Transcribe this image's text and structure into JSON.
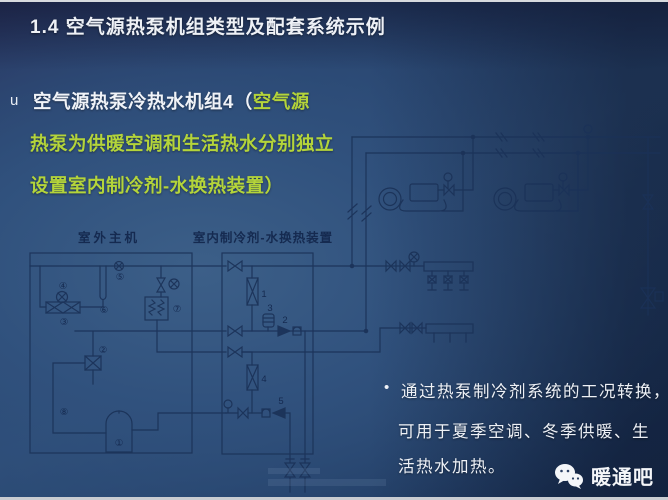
{
  "slide": {
    "title": "1.4 空气源热泵机组类型及配套系统示例",
    "bullet": {
      "marker": "u",
      "white_text": "空气源热泵冷热水机组4（",
      "green_inline": "空气源",
      "green_line2": "热泵为供暖空调和生活热水分别独立",
      "green_line3": "设置室内制冷剂-水换热装置）"
    },
    "note": {
      "marker": "•",
      "line1": "通过热泵制冷剂系统的工况转换，",
      "line2": "可用于夏季空调、冬季供暖、生",
      "line3": "活热水加热。"
    },
    "footer": {
      "brand": "暖通吧",
      "icon": "wechat-icon"
    }
  },
  "diagram": {
    "outdoor_label": "室外主机",
    "indoor_label": "室内制冷剂-水换热装置",
    "outdoor_numbers": {
      "n1": "①",
      "n2": "②",
      "n3": "③",
      "n4": "④",
      "n5": "⑤",
      "n6": "⑥",
      "n7": "⑦",
      "n8": "⑧"
    },
    "indoor_numbers": {
      "n1": "1",
      "n2": "2",
      "n3": "3",
      "n4": "4",
      "n5": "5"
    }
  },
  "colors": {
    "background_mid": "#2c4b75",
    "background_edge": "#192e51",
    "title_text": "#eef1f6",
    "accent_green": "#b4d43a",
    "diagram_line": "#1b3258"
  }
}
